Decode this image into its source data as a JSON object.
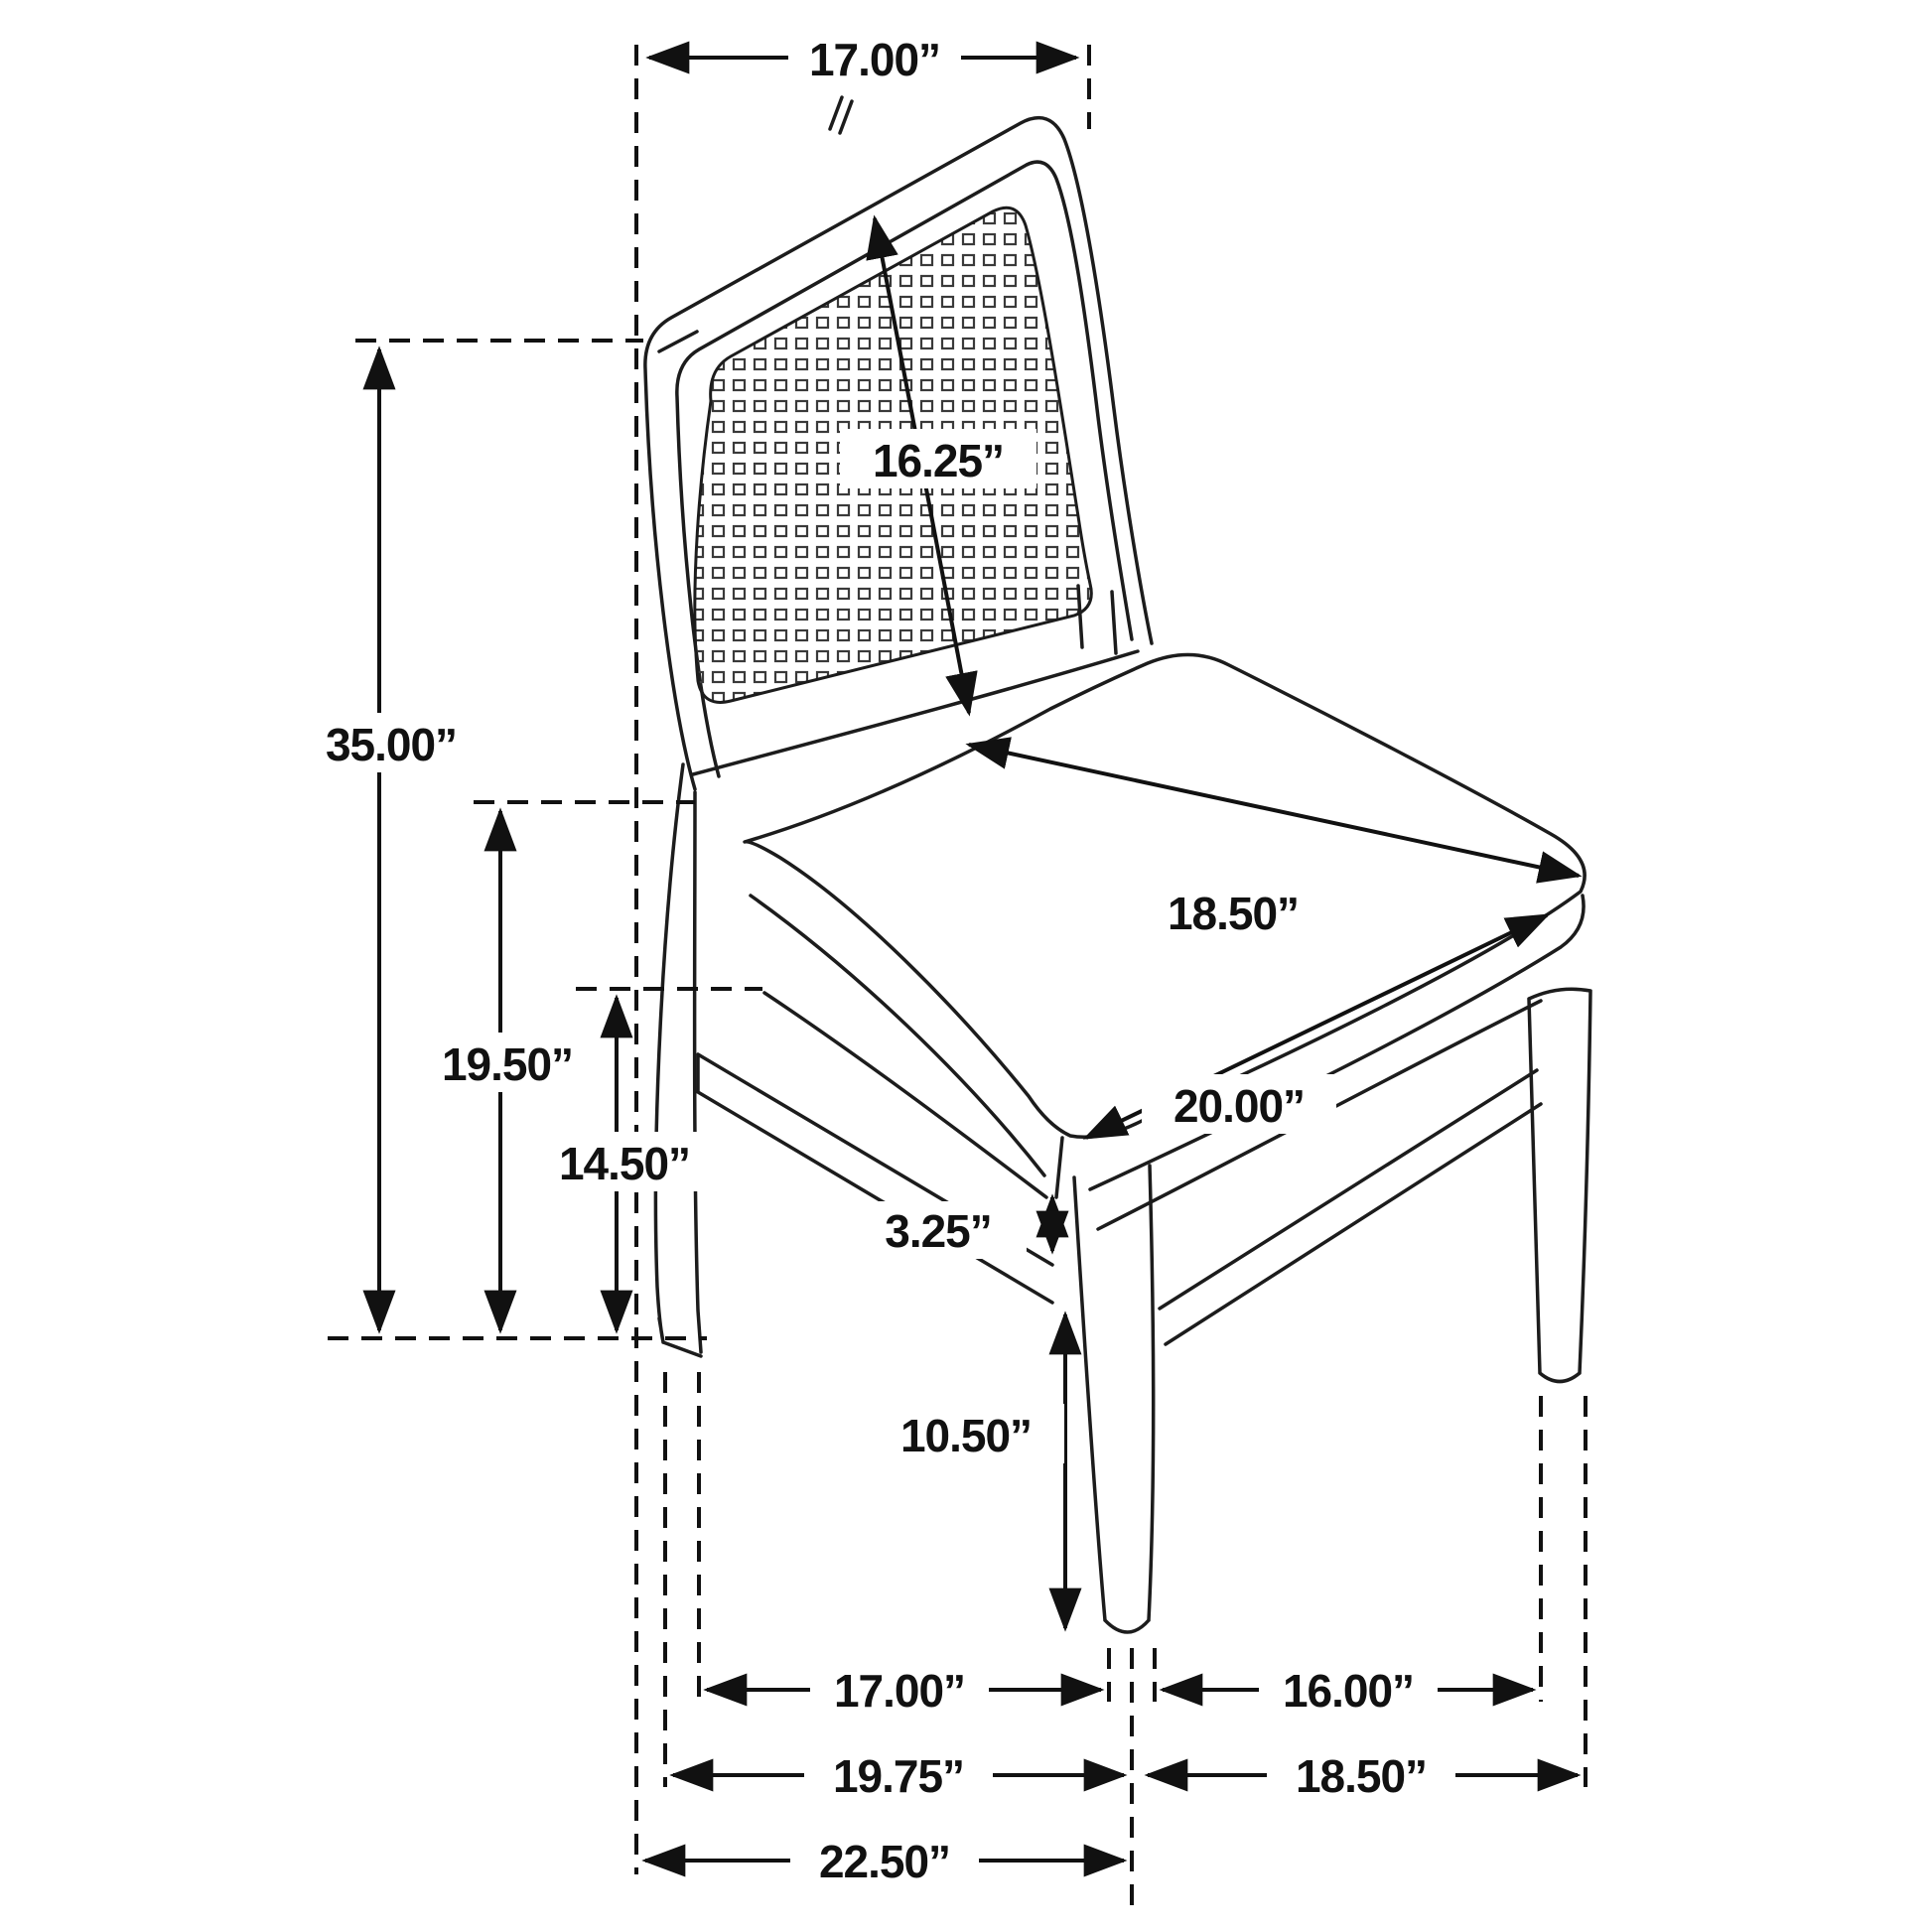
{
  "page": {
    "background": "#ffffff"
  },
  "diagram": {
    "type": "technical-drawing",
    "subject": "Dining side chair with cane back and upholstered seat — dimensioned line drawing",
    "unit": "inches",
    "line_color": "#1c1c1c",
    "dimensions": {
      "back_top_width": "17.00”",
      "back_panel_diagonal": "16.25”",
      "overall_height": "35.00”",
      "seat_height": "19.50”",
      "seat_frame_height": "14.50”",
      "seat_depth": "18.50”",
      "seat_width": "20.00”",
      "apron_to_stretcher_gap": "3.25”",
      "stretcher_to_floor": "10.50”",
      "rear_to_front_leg_span": "17.00”",
      "front_to_side_leg_span": "16.00”",
      "base_depth": "19.75”",
      "base_width": "18.50”",
      "overall_depth": "22.50”"
    }
  }
}
